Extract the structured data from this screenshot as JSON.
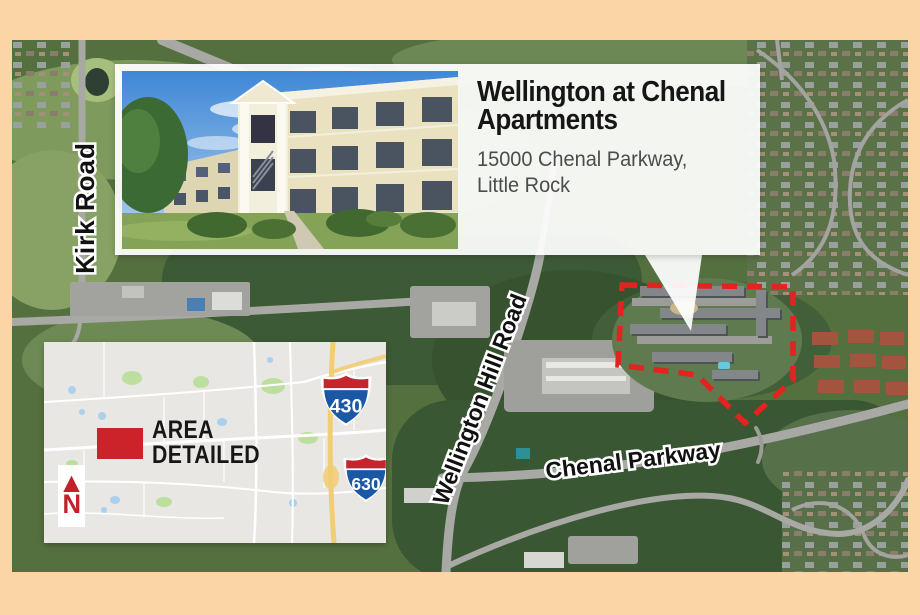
{
  "callout": {
    "title_line1": "Wellington at Chenal",
    "title_line2": "Apartments",
    "address_line1": "15000 Chenal Parkway,",
    "address_line2": "Little Rock"
  },
  "road_labels": {
    "kirk": "Kirk Road",
    "wellington": "Wellington Hill Road",
    "chenal": "Chenal Parkway"
  },
  "inset": {
    "area_line1": "AREA",
    "area_line2": "DETAILED",
    "north_label": "N",
    "north_arrow_glyph": "▲",
    "interstate_430": "430",
    "interstate_630": "630"
  },
  "colors": {
    "page_border": "#fbd5a5",
    "highlight_dash_red": "#e42320",
    "area_rect_red": "#cb2329",
    "shield_red": "#c6252e",
    "shield_blue": "#1a57a5",
    "callout_background": "#ffffff",
    "address_text": "#4c4c4c",
    "inset_background": "#e9e7e4"
  }
}
